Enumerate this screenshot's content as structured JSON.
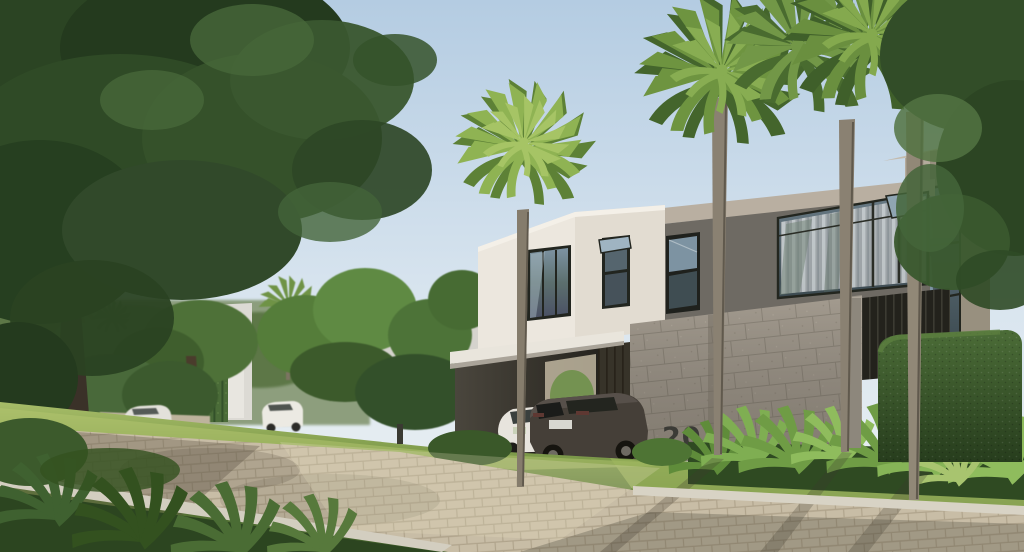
{
  "scene": {
    "house_number": "20"
  },
  "palette": {
    "sky_top": "#b4cce2",
    "sky_horizon": "#eef2f3",
    "facade_white": "#ece7de",
    "facade_beige_fascia": "#b9afa1",
    "facade_dark_gray": "#6e6a63",
    "facade_tall_lit": "#b4aa9c",
    "facade_tall_shade": "#98907f",
    "stone_wall": "#a39b8f",
    "glass_dark": "#47565e",
    "curtain_light": "#ccd1d3",
    "canopy_white": "#e9e5dc",
    "garage_door": "#373329",
    "road_paver": "#c8bda6",
    "curb_concrete": "#d8d3c5",
    "grass_light": "#9cb55e",
    "grass_dark": "#3d5a28",
    "hedge_green": "#35522a",
    "tree_dark_green": "#263d1f",
    "palm_green": "#7da347",
    "suv_color": "#453f38",
    "sedan_color": "#e7e4dd",
    "house_number_color": "#3b3b36"
  }
}
